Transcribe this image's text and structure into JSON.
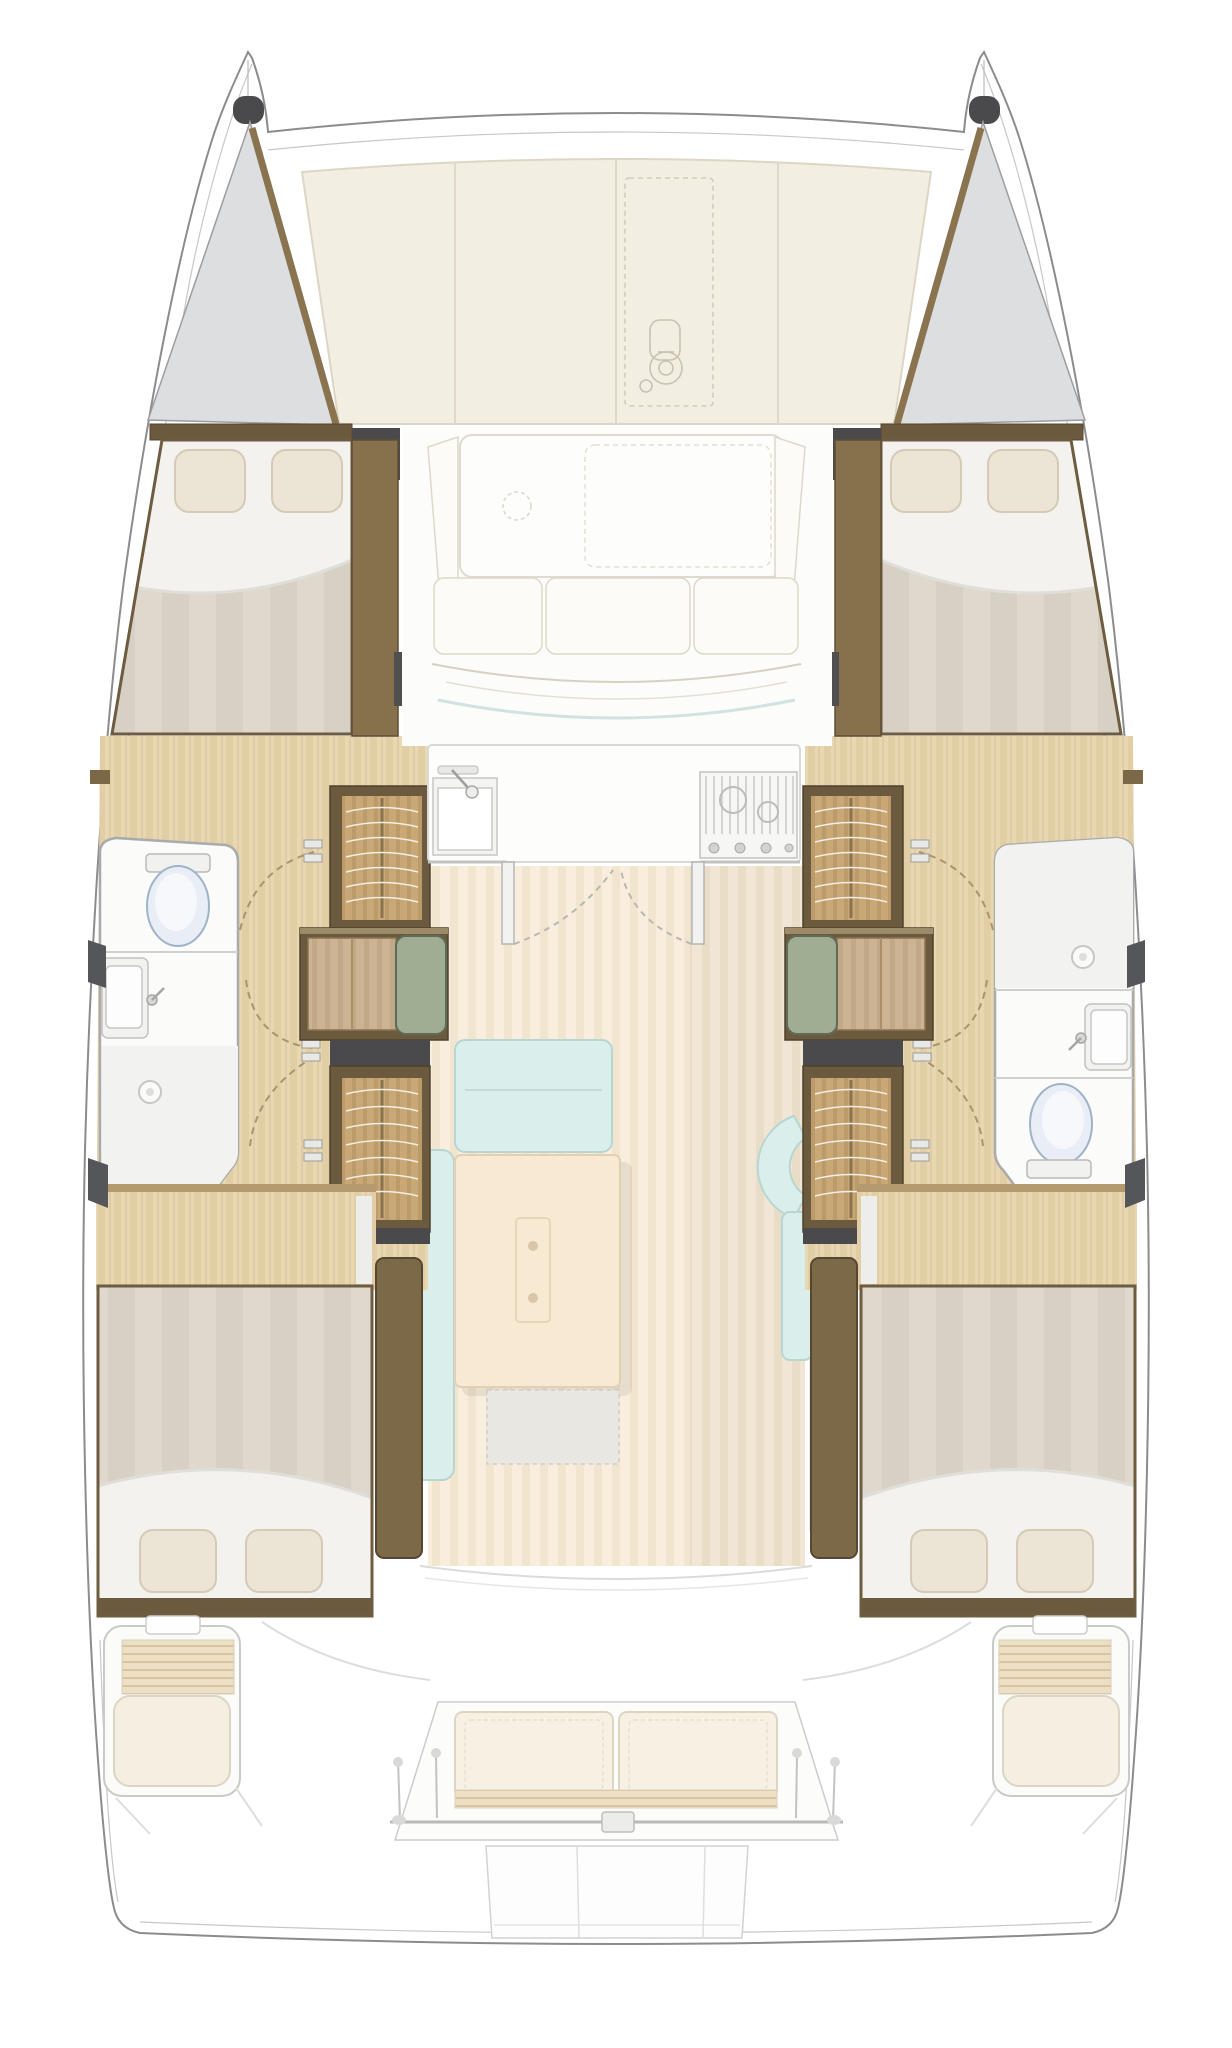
{
  "page": {
    "kind": "catamaran interior floor plan, overhead view, no visible text",
    "background": "#ffffff",
    "width_px": 1232,
    "height_px": 2048
  },
  "vessel": {
    "type": "sailing-catamaran",
    "view": "top-down-deck-and-interior-layout",
    "hulls": 2,
    "cabins": 4,
    "double_berths": 4,
    "bathrooms": 2,
    "wardrobes": 4,
    "helm_side_seats": 2
  },
  "palette": {
    "hull_outline": "#8b8c8e",
    "hull_inner_line": "#c6c7c9",
    "trampoline": "#dcdee0",
    "trampoline_edge": "#9c9da0",
    "deck_cushion": "#f3eee2",
    "deck_cushion_edge": "#ddd6c5",
    "wood_trim": "#8a7450",
    "wood_trim_dark": "#6b5a3e",
    "wood_trim_deep": "#554731",
    "wood_highlight": "#9c8a68",
    "charcoal": "#4a4a4c",
    "floor_wood": "#e8d7b0",
    "floor_wood_grain": "#dcc69c",
    "wardrobe_wood": "#c9a876",
    "wardrobe_wood_grain": "#b08d5e",
    "wardrobe_arc": "#f2eee4",
    "duvet_a": "#d7d0c4",
    "duvet_b": "#dfd9cd",
    "sheet": "#f3f2ee",
    "pillow": "#ece5d5",
    "pillow_edge": "#d4cab6",
    "bathroom_floor": "#fbfbfa",
    "bathroom_edge": "#a9aaac",
    "shower_floor": "#f2f2f0",
    "toilet": "#e9eef6",
    "toilet_edge": "#9fb3c8",
    "sofa_blue": "#daeeec",
    "sofa_blue_edge": "#b7d6d2",
    "table_cream": "#f8e9d3",
    "table_edge": "#e2d0b6",
    "green_cushion": "#9fae93",
    "green_cushion_edge": "#5f6b57",
    "cockpit_cushion": "#f4efe1",
    "cockpit_cushion_edge": "#dcd5c3",
    "slat": "#ecdfc6",
    "slat_line": "#d6c5a0",
    "salon_floor": "#f9eedd",
    "salon_floor_stripe": "#f0e2cc",
    "white_fixture": "#fdfdfc",
    "fixture_edge": "#c9c9c7"
  },
  "areas": {
    "foredeck": {
      "elements": [
        "port-bow",
        "starboard-bow",
        "port-bow-trampoline",
        "starboard-bow-trampoline",
        "foredeck-cushion-panels",
        "anchor-locker-hatch",
        "windlass"
      ]
    },
    "forward_lounge": {
      "elements": [
        "forward-sunpad",
        "bench-cushions",
        "angled-backrests"
      ]
    },
    "galley": {
      "elements": [
        "counter",
        "sink",
        "mixer-tap",
        "three-burner-stove",
        "double-doors-to-salon"
      ]
    },
    "salon": {
      "elements": [
        "l-shaped-sofa",
        "coffee-table",
        "table-rug",
        "curved-chaise-seat",
        "side-bench",
        "companionway-steps"
      ]
    },
    "port_hull": {
      "forward_cabin": [
        "double-berth",
        "two-pillows",
        "hanging-locker-band"
      ],
      "bathroom": [
        "toilet-forward",
        "washbasin",
        "shower-aft",
        "shower-drain"
      ],
      "midship": [
        "upper-wardrobe",
        "vanity-desk-with-green-cushion",
        "lower-wardrobe",
        "cabin-doors"
      ],
      "aft_cabin": [
        "double-berth",
        "two-pillows",
        "wood-floor-landing"
      ]
    },
    "starboard_hull": {
      "forward_cabin": [
        "double-berth",
        "two-pillows",
        "hanging-locker-band"
      ],
      "bathroom": [
        "shower-forward",
        "shower-drain",
        "washbasin",
        "toilet-aft"
      ],
      "midship": [
        "upper-wardrobe",
        "vanity-desk-with-green-cushion",
        "lower-wardrobe",
        "cabin-doors"
      ],
      "aft_cabin": [
        "double-berth",
        "two-pillows",
        "wood-floor-landing"
      ]
    },
    "aft_cockpit": {
      "elements": [
        "aft-bench-two-cushions",
        "bench-slat-front",
        "pushpit-rail-and-stanchions",
        "port-side-seat-with-slats",
        "starboard-side-seat-with-slats",
        "side-consoles",
        "swim-platform",
        "transom-steps"
      ]
    }
  }
}
